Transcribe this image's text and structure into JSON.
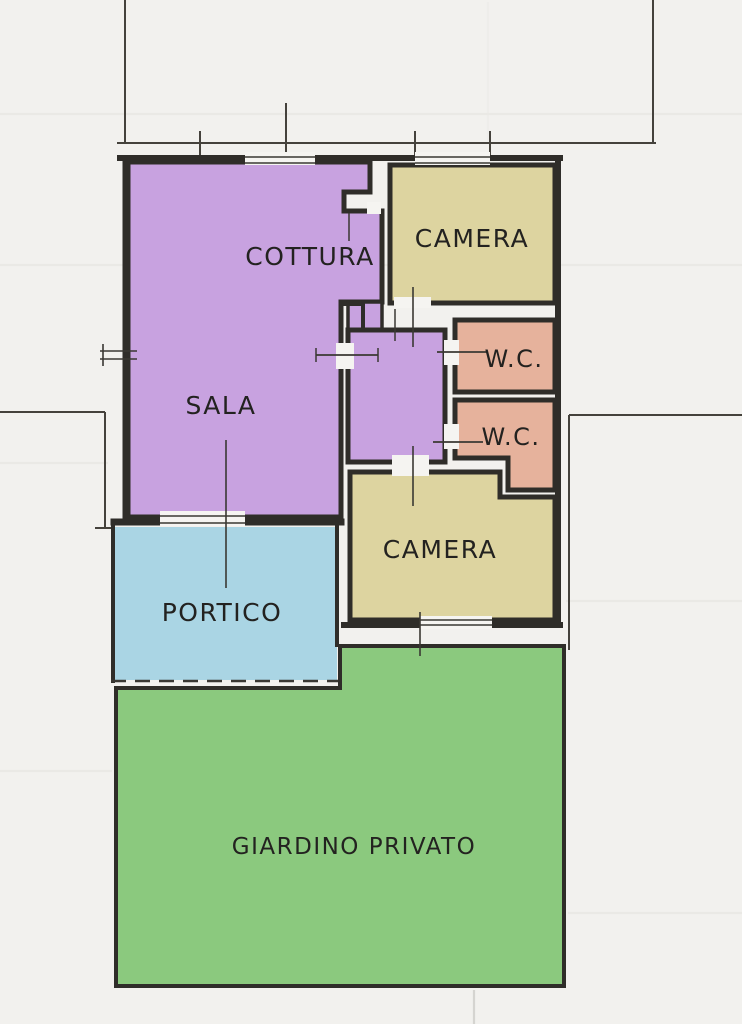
{
  "plan": {
    "rooms": [
      {
        "id": "sala",
        "label": "SALA",
        "color": "#c8a2e0"
      },
      {
        "id": "cottura",
        "label": "COTTURA",
        "color": "#c8a2e0"
      },
      {
        "id": "camera-nord",
        "label": "CAMERA",
        "color": "#ddd4a0"
      },
      {
        "id": "wc-nord",
        "label": "W.C.",
        "color": "#e6b29c"
      },
      {
        "id": "wc-sud",
        "label": "W.C.",
        "color": "#e6b29c"
      },
      {
        "id": "camera-sud",
        "label": "CAMERA",
        "color": "#ddd4a0"
      },
      {
        "id": "portico",
        "label": "PORTICO",
        "color": "#aad5e4"
      },
      {
        "id": "giardino",
        "label": "GIARDINO PRIVATO",
        "color": "#8bc97e"
      }
    ],
    "palette": {
      "paper": "#f2f1ee",
      "wall": "#2f2d29",
      "boundary": "#45423c",
      "detail": "#3a3833",
      "label": "#232220",
      "gap": "#f5f4f1"
    }
  }
}
